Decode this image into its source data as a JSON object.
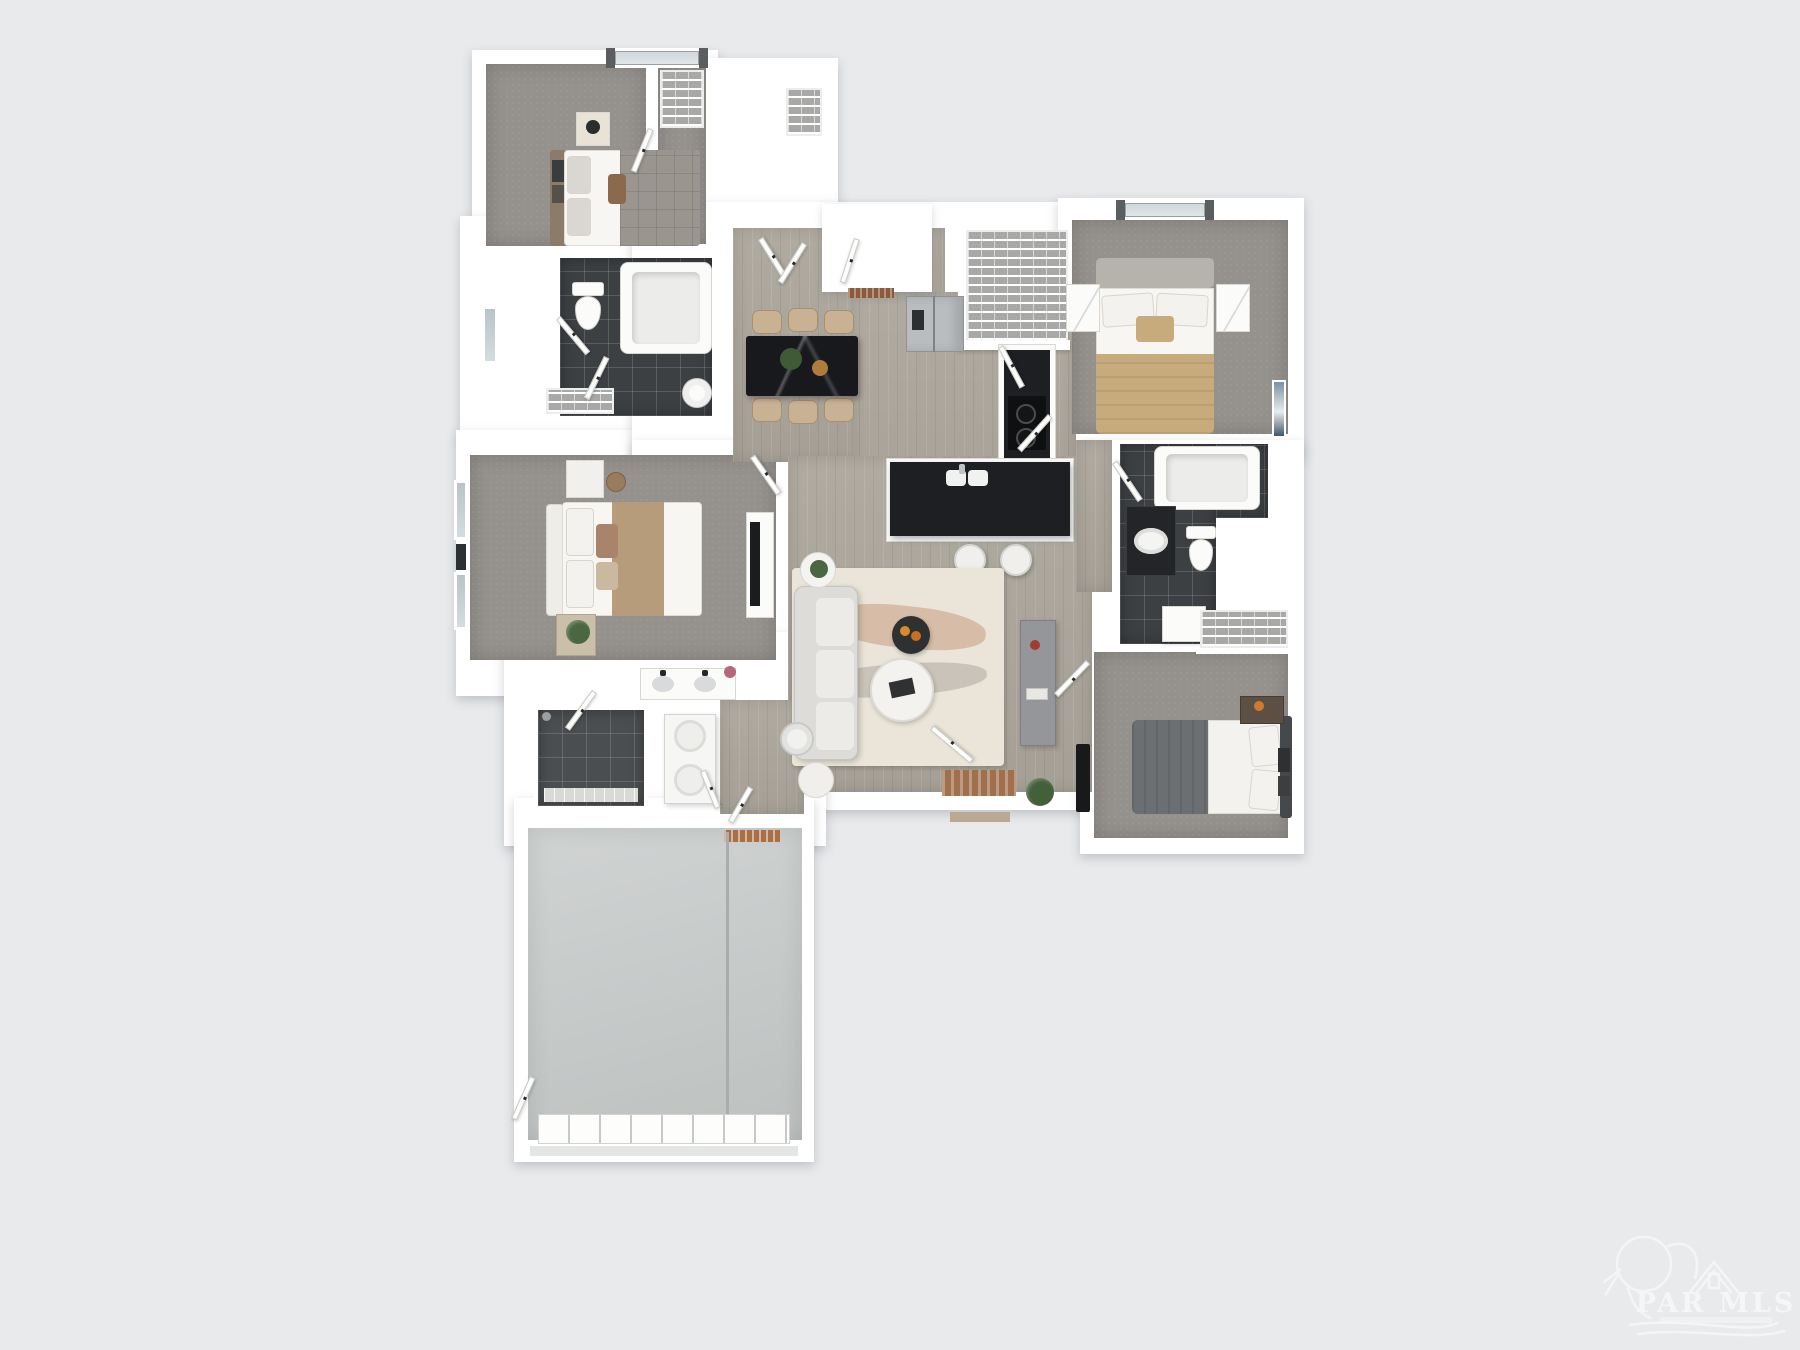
{
  "watermark": {
    "title": "PAR MLS",
    "icons": [
      "pelican-icon",
      "house-outline-icon",
      "swoosh-icon"
    ]
  },
  "palette": {
    "background": "#e8eaec",
    "wall": "#ffffff",
    "wood": "#aca69c",
    "carpet": "#95918d",
    "tile": "#3d4043",
    "shelf": "#a8a8a6",
    "concrete": "#c7cbca",
    "counter": "#1d1f22",
    "steel": "#b9bdbf",
    "rug": "#eae4d9",
    "chair": "#c9b294",
    "tan": "#c8ab7d",
    "slate": "#6b6f72",
    "mat": "#a06f4c",
    "plant": "#4a6741",
    "wood_dark": "#8b7b68"
  }
}
